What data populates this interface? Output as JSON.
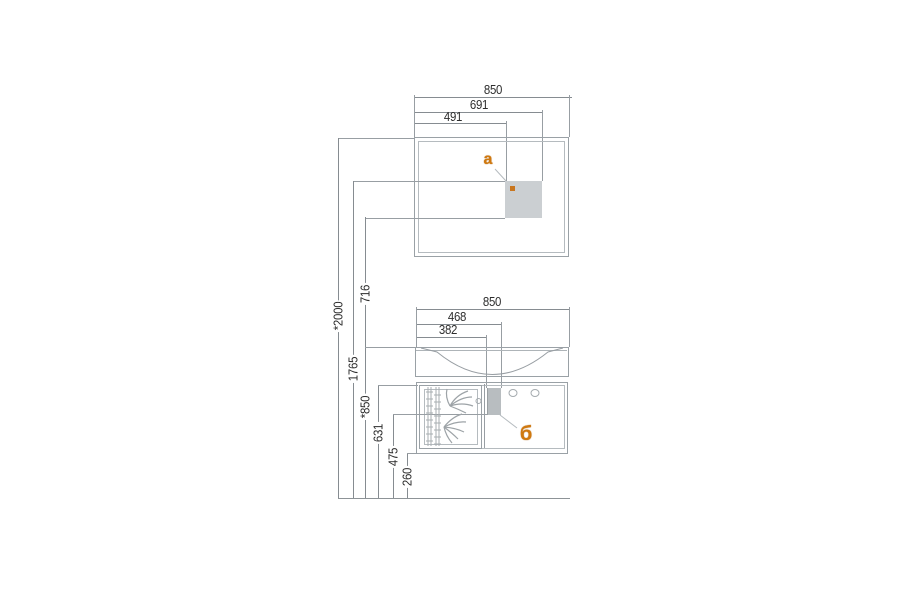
{
  "drawing_title": "bathroom vanity and mirror dimension drawing",
  "colors": {
    "background": "#ffffff",
    "line": "#989ea3",
    "dimension_line": "#868c91",
    "text": "#2d2d2d",
    "accent_orange": "#d0790f",
    "panel_gray_a": "#cbcfd2",
    "panel_gray_b": "#b8bdc0"
  },
  "mirror": {
    "dims": [
      {
        "label": "850"
      },
      {
        "label": "691"
      },
      {
        "label": "491"
      }
    ],
    "marker": "a"
  },
  "vanity": {
    "dims": [
      {
        "label": "850"
      },
      {
        "label": "468"
      },
      {
        "label": "382"
      }
    ],
    "marker": "б"
  },
  "left_dims": [
    {
      "label": "*2000"
    },
    {
      "label": "1765"
    },
    {
      "label": "716"
    },
    {
      "label": "*850"
    },
    {
      "label": "631"
    },
    {
      "label": "475"
    },
    {
      "label": "260"
    }
  ]
}
